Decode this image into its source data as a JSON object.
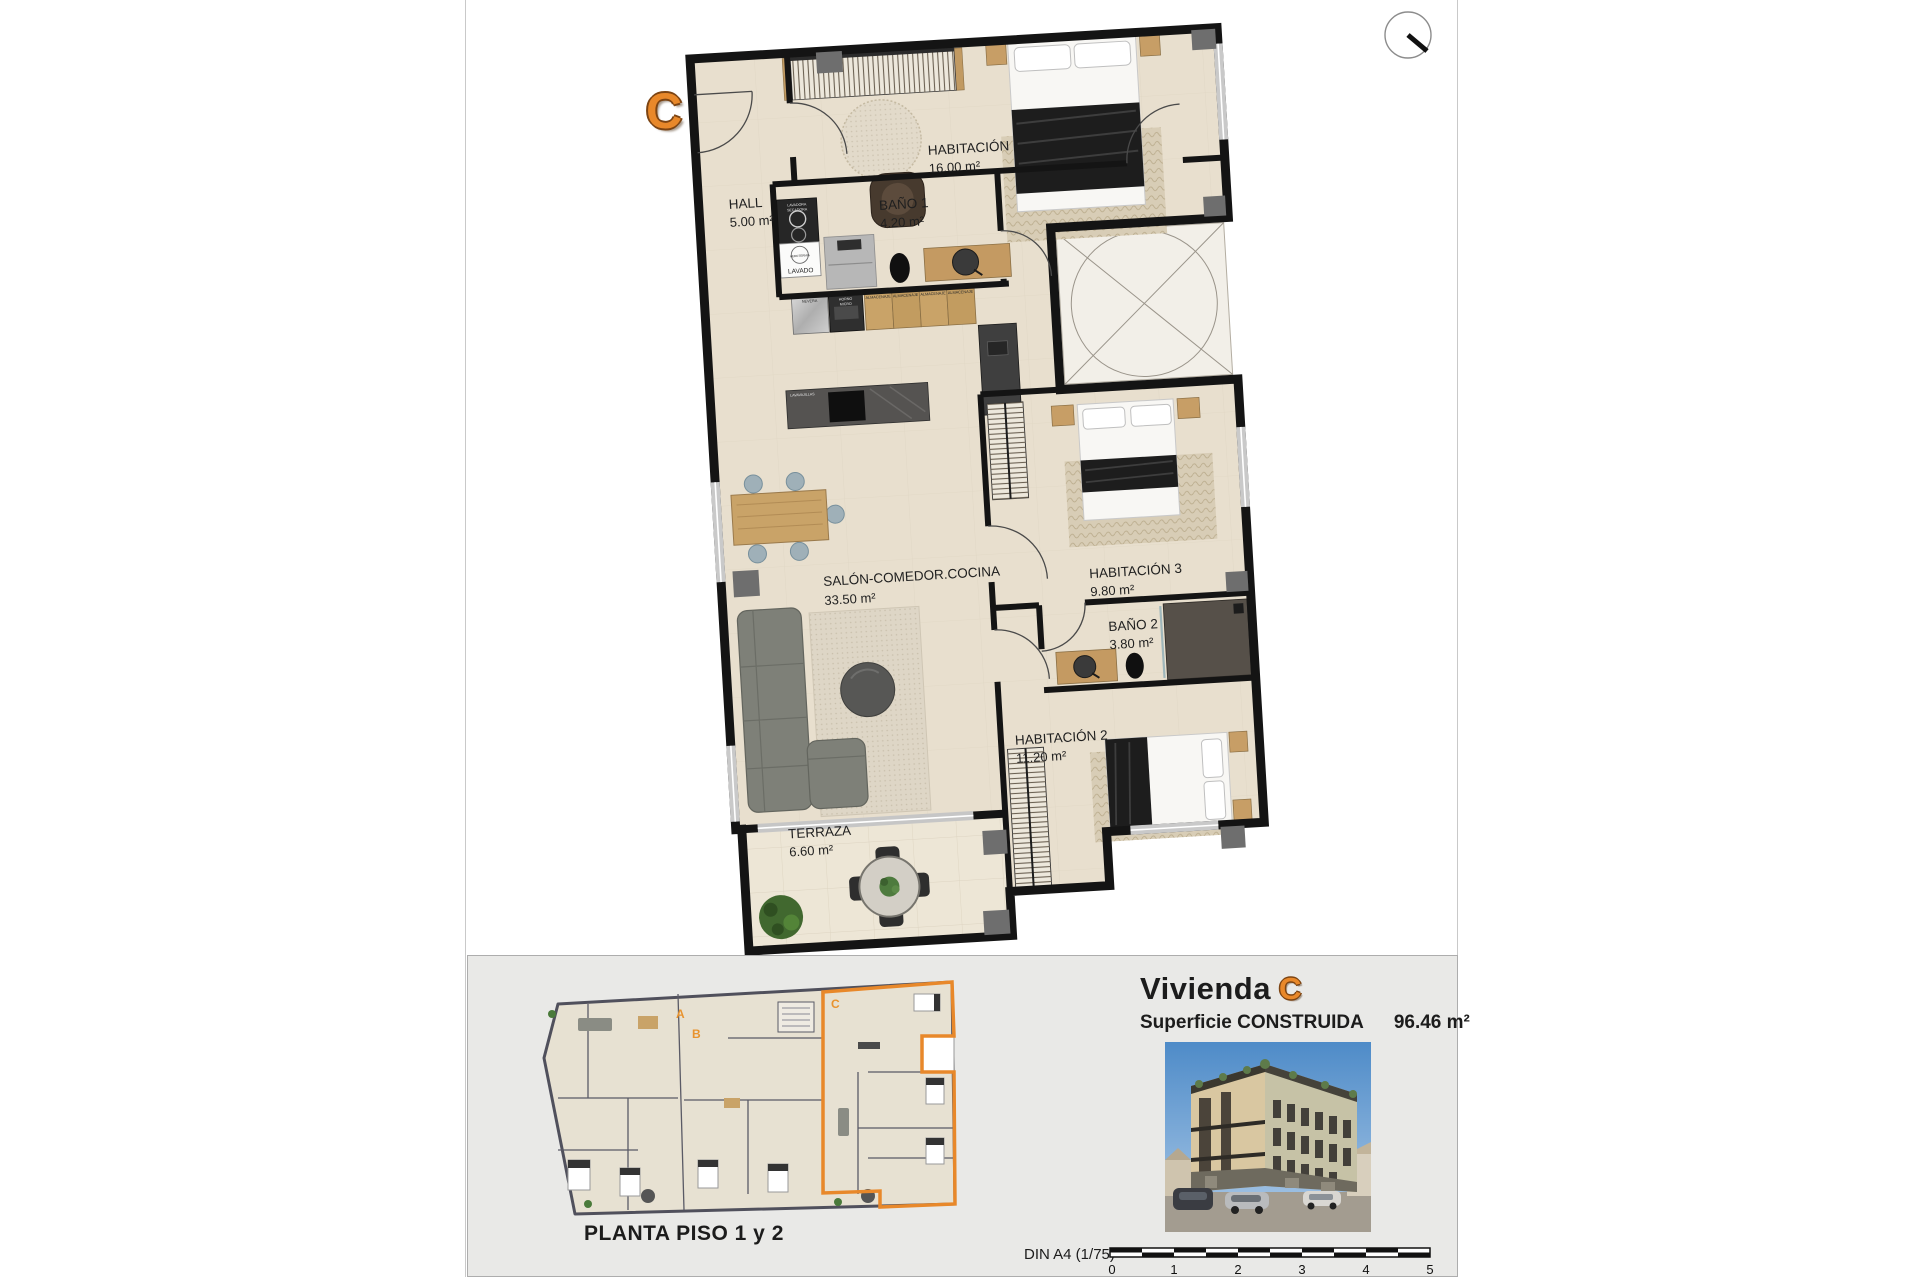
{
  "plan": {
    "unit_letter": "C",
    "rooms": [
      {
        "name": "HALL",
        "area": "5.00 m²"
      },
      {
        "name": "HABITACIÓN 1",
        "area": "16.00 m²"
      },
      {
        "name": "BAÑO 1",
        "area": "4.20 m²"
      },
      {
        "name": "SALÓN-COMEDOR.COCINA",
        "area": "33.50 m²"
      },
      {
        "name": "HABITACIÓN 3",
        "area": "9.80 m²"
      },
      {
        "name": "BAÑO 2",
        "area": "3.80 m²"
      },
      {
        "name": "HABITACIÓN 2",
        "area": "11.20 m²"
      },
      {
        "name": "TERRAZA",
        "area": "6.60 m²"
      }
    ],
    "appliances": {
      "washer_l1": "LAVADORA",
      "washer_l2": "SECADORA",
      "aerotermia": "AEROTERMIA",
      "lavado": "LAVADO",
      "nevera": "NEVERA",
      "horno_l1": "HORNO",
      "horno_l2": "MICRO",
      "almacenaje": "ALMACENAJE",
      "lavavajillas": "LAVAVAJILLAS"
    }
  },
  "overview": {
    "title": "PLANTA PISO 1 y 2",
    "units": [
      "A",
      "B",
      "C"
    ]
  },
  "info": {
    "title_prefix": "Vivienda",
    "unit": "C",
    "surface_label": "Superficie CONSTRUIDA",
    "surface_value": "96.46 m²"
  },
  "scalebar": {
    "label": "DIN A4 (1/75)",
    "ticks": [
      "0",
      "1",
      "2",
      "3",
      "4",
      "5"
    ]
  },
  "colors": {
    "accent": "#E8882A",
    "wall": "#141414",
    "floor": "#E8DFCE",
    "panel": "#E9E9E7"
  }
}
